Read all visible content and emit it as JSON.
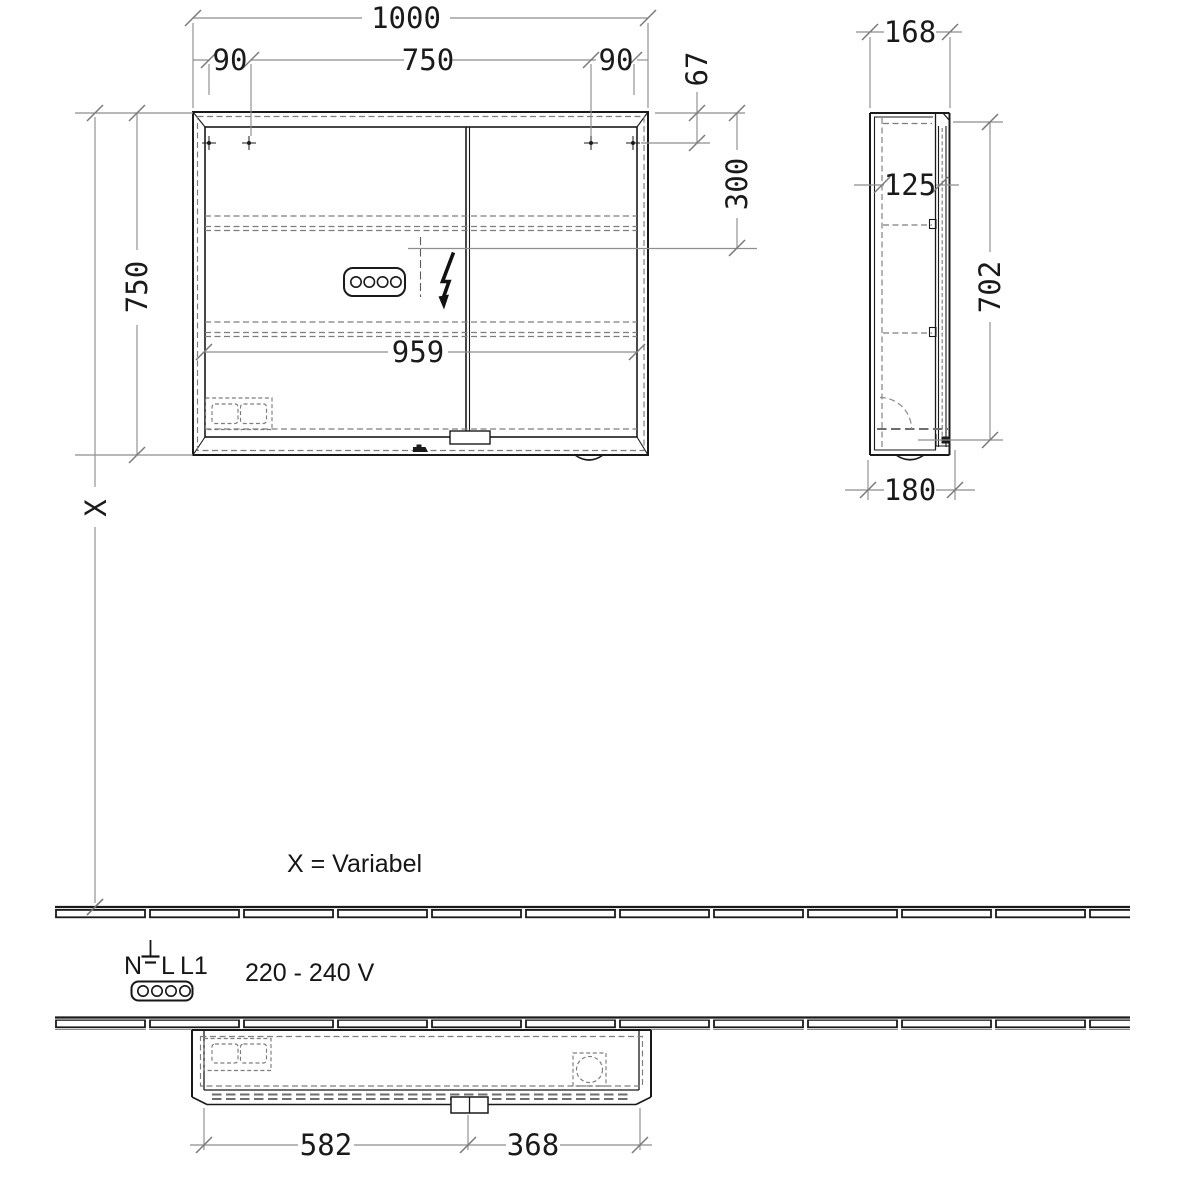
{
  "drawing": {
    "front": {
      "total_width": "1000",
      "hole_gap_left": "90",
      "hole_span": "750",
      "hole_gap_right": "90",
      "height": "750",
      "hole_top_offset": "67",
      "connection_height": "300",
      "inner_width": "959"
    },
    "side": {
      "depth": "168",
      "inner_depth": "125",
      "door_height": "702",
      "total_depth": "180"
    },
    "top": {
      "left_door_width": "582",
      "right_door_width": "368"
    },
    "notes": {
      "x_symbol": "X",
      "x_variable": "X = Variabel",
      "voltage": "220 - 240 V",
      "terminal_n": "N",
      "terminal_l": "L",
      "terminal_l1": "L1"
    }
  }
}
